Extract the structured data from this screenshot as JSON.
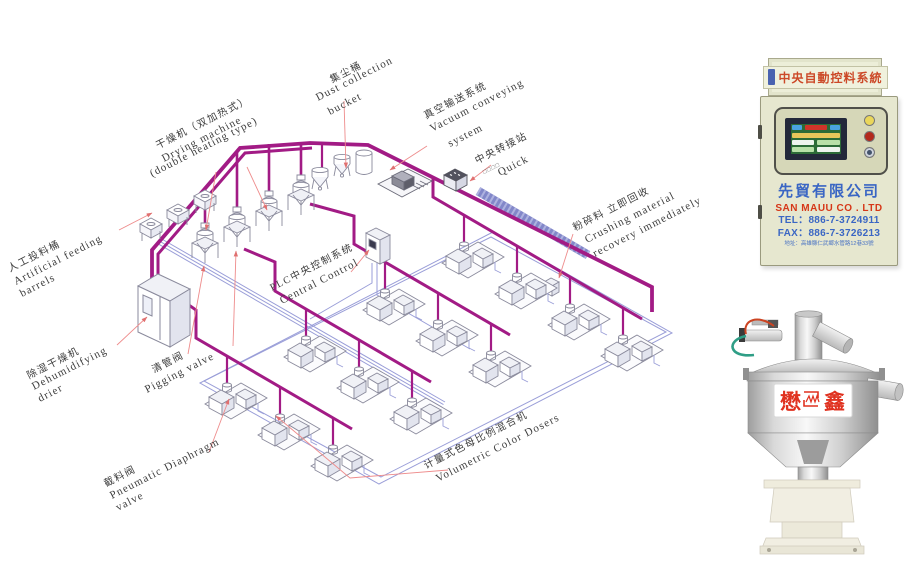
{
  "diagram": {
    "labels": {
      "artificial_feeding": {
        "zh": "人工投料桶",
        "en1": "Artificial feeding",
        "en2": "barrels"
      },
      "drying_machine": {
        "zh": "干燥机（双加热式）",
        "en1": "Drying machine",
        "en2": "(double heating type)"
      },
      "dust_collection": {
        "zh": "集尘桶",
        "en1": "Dust collection",
        "en2": "bucket"
      },
      "vacuum_conveying": {
        "zh": "真空输送系统",
        "en1": "Vacuum conveying",
        "en2": "system"
      },
      "transfer_station": {
        "zh": "中央转接站",
        "sub": "□□□□",
        "en1": "Quick"
      },
      "crushing": {
        "zh": "粉碎料 立即回收",
        "en1": "Crushing material",
        "en2": "recovery immediately"
      },
      "plc": {
        "zh": "PLC中央控制系统",
        "en1": "Central Control"
      },
      "dehumidifying": {
        "zh": "除湿干燥机",
        "en1": "Dehumidifying",
        "en2": "drier"
      },
      "pigging": {
        "zh": "清管阀",
        "en1": "Pigging valve"
      },
      "pneumatic": {
        "zh": "截料阀",
        "en1": "Pneumatic Diaphragm",
        "en2": "valve"
      },
      "volumetric": {
        "zh": "计量式色母比例混合机",
        "en1": "Volumetric Color Dosers"
      }
    },
    "colors": {
      "pipe": "#a21b85",
      "band": "#8287c9",
      "wire": "#9a9ed8",
      "leader": "#ee8c8c",
      "outline": "#8a8a9c"
    }
  },
  "control_panel": {
    "header": "中央自動控料系統",
    "company_zh": "先貿有限公司",
    "company_en": "SAN MAUU CO . LTD",
    "tel": "TEL：886-7-3724911",
    "fax": "FAX：886-7-3726213",
    "address": "地址：高雄縣仁武鄉水管路12巷33號"
  },
  "hopper_machine": {
    "brand_left": "懋",
    "brand_right": "鑫"
  }
}
